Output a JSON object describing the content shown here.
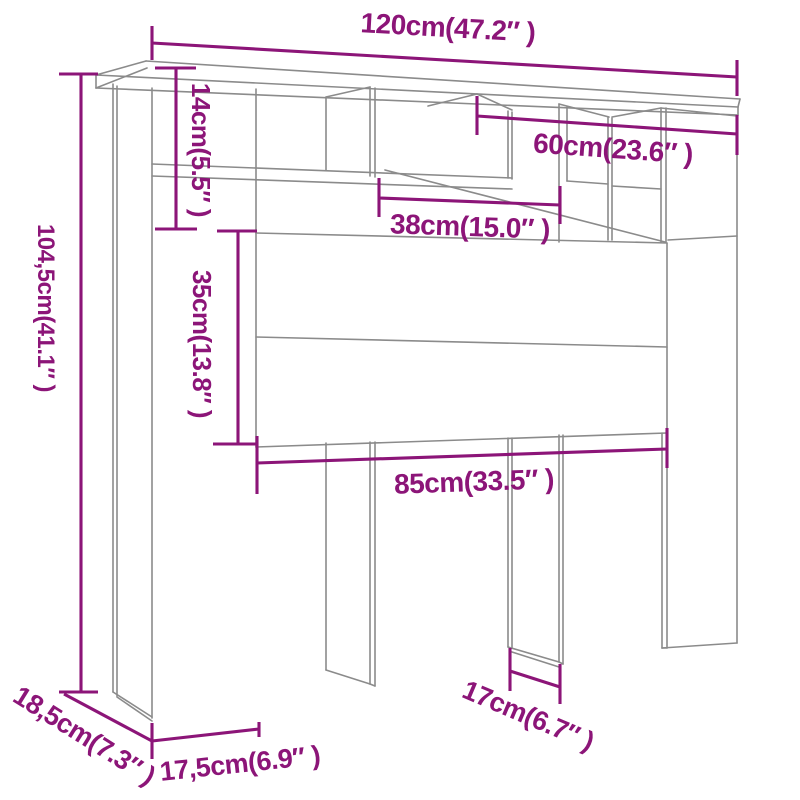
{
  "diagram": {
    "kind": "furniture-dimension-diagram",
    "subject": "headboard storage cabinet wireframe drawing",
    "background_color": "#ffffff",
    "outline_color": "#8b8b8b",
    "dimension_color": "#8c1578",
    "labels": {
      "total_width": "120cm(47.2″ )",
      "shelf_height": "14cm(5.5″ )",
      "right_section_width": "60cm(23.6″ )",
      "inner_width": "38cm(15.0″ )",
      "panel_height": "35cm(13.8″ )",
      "total_height": "104,5cm(41.1″ )",
      "panel_width": "85cm(33.5″ )",
      "leg_gap_width": "17cm(6.7″ )",
      "side_depth": "18,5cm(7.3″ )",
      "base_depth": "17,5cm(6.9″ )"
    }
  }
}
